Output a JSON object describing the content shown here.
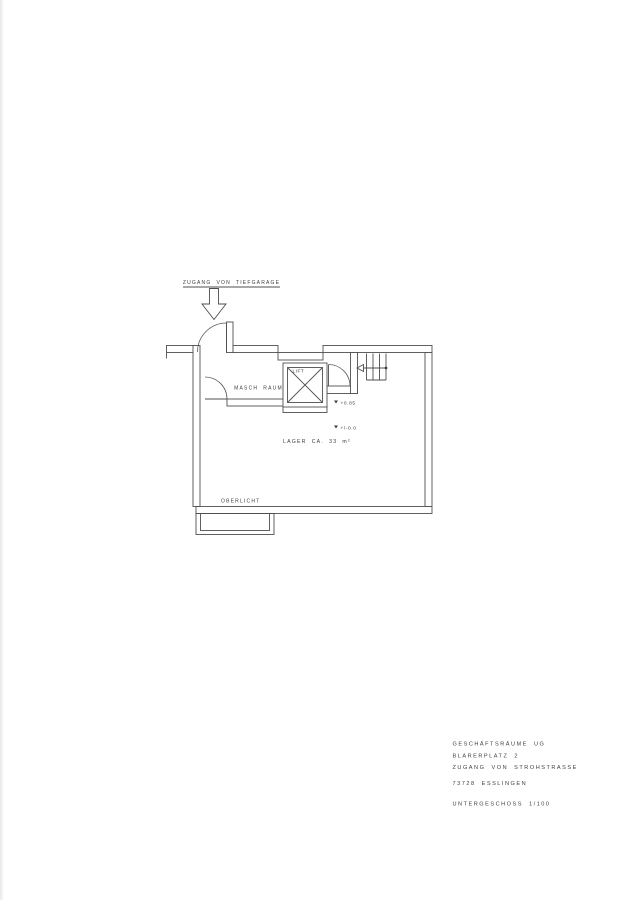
{
  "page": {
    "background": "#ffffff",
    "line_color": "#4f4f4f",
    "text_color": "#3d3d3d"
  },
  "plan": {
    "entrance_label": "ZUGANG VON TIEFGARAGE",
    "labels": {
      "masch_raum": "MASCH RAUM",
      "lift": "LIFT",
      "lager": "LAGER CA. 33 m²",
      "oberlicht": "OBERLICHT"
    },
    "levels": {
      "landing": "+0.85",
      "floor": "+/-0.0"
    }
  },
  "title_block": {
    "lines": [
      "GESCHÄFTSRÄUME UG",
      "BLARERPLATZ 2",
      "ZUGANG VON STROHSTRASSE",
      "73728 ESSLINGEN",
      "UNTERGESCHOSS  1/100"
    ]
  }
}
